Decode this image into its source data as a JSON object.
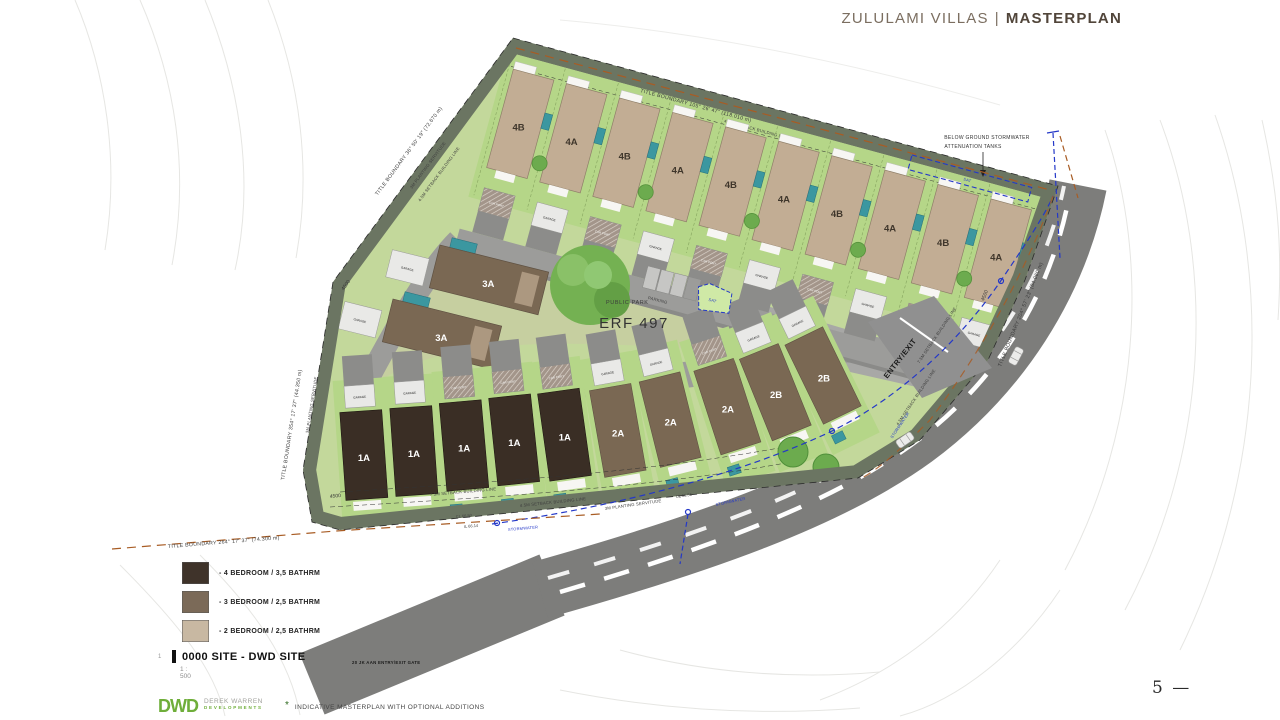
{
  "header": {
    "project": "ZULULAMI VILLAS",
    "divider": "|",
    "page_title": "MASTERPLAN"
  },
  "plan": {
    "erf": "ERF 497",
    "public_park": "PUBLIC PARK",
    "parking": "PARKING",
    "sat": "SAT",
    "entry_exit": "ENTRY/EXIT",
    "stormwater": "STORMWATER",
    "attenuation_line1": "BELOW GROUND STORMWATER",
    "attenuation_line2": "ATTENUATION TANKS",
    "gate": "20 JK AAN ENTRY/EXIT GATE",
    "garage": "GARAGE",
    "car_port": "CAR PORT",
    "dim": "4500",
    "cl_a": "CL 66.50",
    "il_a": "IL 66.14",
    "cl_b": "CL 65.56",
    "boundary_top": "TITLE BOUNDARY  105° 26' 47\" (118.010 m)",
    "boundary_left_upper": "TITLE BOUNDARY  36° 50' 19\" (72.670 m)",
    "boundary_left_lower": "TITLE BOUNDARY  354° 17' 37\" (44.350 m)",
    "boundary_bottom": "TITLE BOUNDARY  264° 17' 37\" (74.300 m)",
    "boundary_right": "TITLE BOUNDARY  204° 57' 23\" (84.060 m)",
    "setback_45": "4.5M SETBACK BUILDING LINE",
    "setback_75": "7.5M SETBACK BUILDING LINE",
    "planting": "3M PLANTING SERVITUDE",
    "top_row_units": [
      "4B",
      "4A",
      "4B",
      "4A",
      "4B",
      "4A",
      "4B",
      "4A",
      "4B",
      "4A"
    ],
    "bottom_row_units": [
      "1A",
      "1A",
      "1A",
      "1A",
      "1A",
      "2A",
      "2A",
      "2A",
      "2B",
      "2B"
    ],
    "middle_units": [
      "3A",
      "3A"
    ],
    "colors": {
      "unit_4bed": "#3a2e25",
      "unit_3bed": "#7a6853",
      "unit_2bed": "#c2ad94",
      "pool_teal": "#3b97a0",
      "plot_green": "#b5d688",
      "park_olive": "#c6cfa0",
      "road_gray": "#7d7d7b",
      "stormwater_blue": "#2438c8",
      "boundary_orange": "#a85c24",
      "servitude_olive": "#6b7562"
    }
  },
  "legend": {
    "items": [
      {
        "label": "- 4 BEDROOM / 3,5 BATHRM",
        "color": "#3f332a"
      },
      {
        "label": "- 3 BEDROOM / 2,5 BATHRM",
        "color": "#7b6a58"
      },
      {
        "label": "- 2 BEDROOM / 2,5 BATHRM",
        "color": "#c8b8a2"
      }
    ],
    "ref_index": "1",
    "site_ref": "0000 SITE - DWD SITE",
    "scale": "1 : 500"
  },
  "footer": {
    "logo": "DWD",
    "logo_line1": "DEREK WARREN",
    "logo_line2": "DEVELOPMENTS",
    "asterisk": "*",
    "note": "INDICATIVE MASTERPLAN WITH OPTIONAL ADDITIONS"
  },
  "page": {
    "number": "5",
    "rule": "—"
  }
}
